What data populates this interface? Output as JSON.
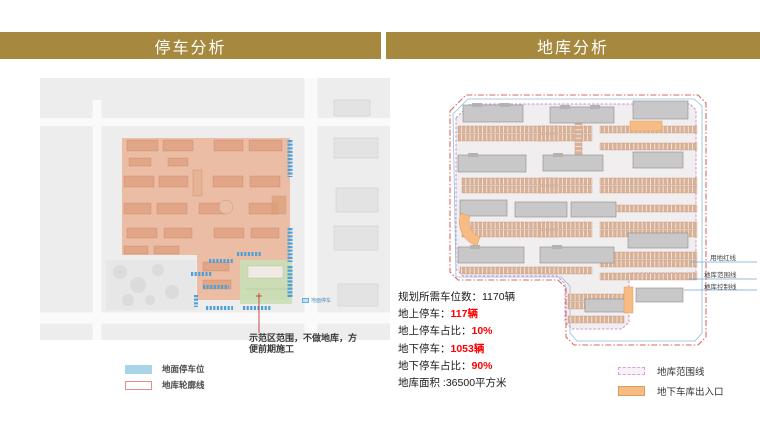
{
  "colors": {
    "banner_gold": "#A6893E",
    "banner_text": "#FFFFFF",
    "accent_red": "#FF0000",
    "map_bg": "#EDEDED",
    "salmon_overlay": "#ECB99E",
    "green_overlay": "#C9DFB6",
    "blue_parking": "#4FA0D6",
    "tan_parking": "#D8B197",
    "building_gray": "#C8C8C8",
    "orange_entry": "#F6BC84",
    "boundary_red": "#D96A5F",
    "boundary_pink": "#CC8FCF",
    "boundary_blue": "#8FBCE0"
  },
  "headers": {
    "left": "停车分析",
    "right": "地库分析"
  },
  "left_panel": {
    "callout": "示范区范围，不做地库，方便前期施工",
    "map_tag": "地面停车",
    "legend": [
      {
        "label": "地面停车位",
        "type": "blue-fill"
      },
      {
        "label": "地库轮廓线",
        "type": "red-outline"
      }
    ]
  },
  "right_panel": {
    "stats": [
      {
        "label": "规划所需车位数：",
        "value": "1170辆",
        "highlight": false
      },
      {
        "label": "地上停车：",
        "value": "117辆",
        "highlight": true
      },
      {
        "label": "地上停车占比：",
        "value": "10%",
        "highlight": true
      },
      {
        "label": "地下停车：",
        "value": "1053辆",
        "highlight": true
      },
      {
        "label": "地下停车占比：",
        "value": "90%",
        "highlight": true
      },
      {
        "label": "地库面积 :",
        "value": "36500平方米",
        "highlight": false
      }
    ],
    "annotations": [
      "用地红线",
      "地库范围线",
      "地库控制线"
    ],
    "legend": [
      {
        "label": "地库范围线",
        "type": "pink-dashed"
      },
      {
        "label": "地下车库出入口",
        "type": "orange-fill"
      }
    ]
  }
}
